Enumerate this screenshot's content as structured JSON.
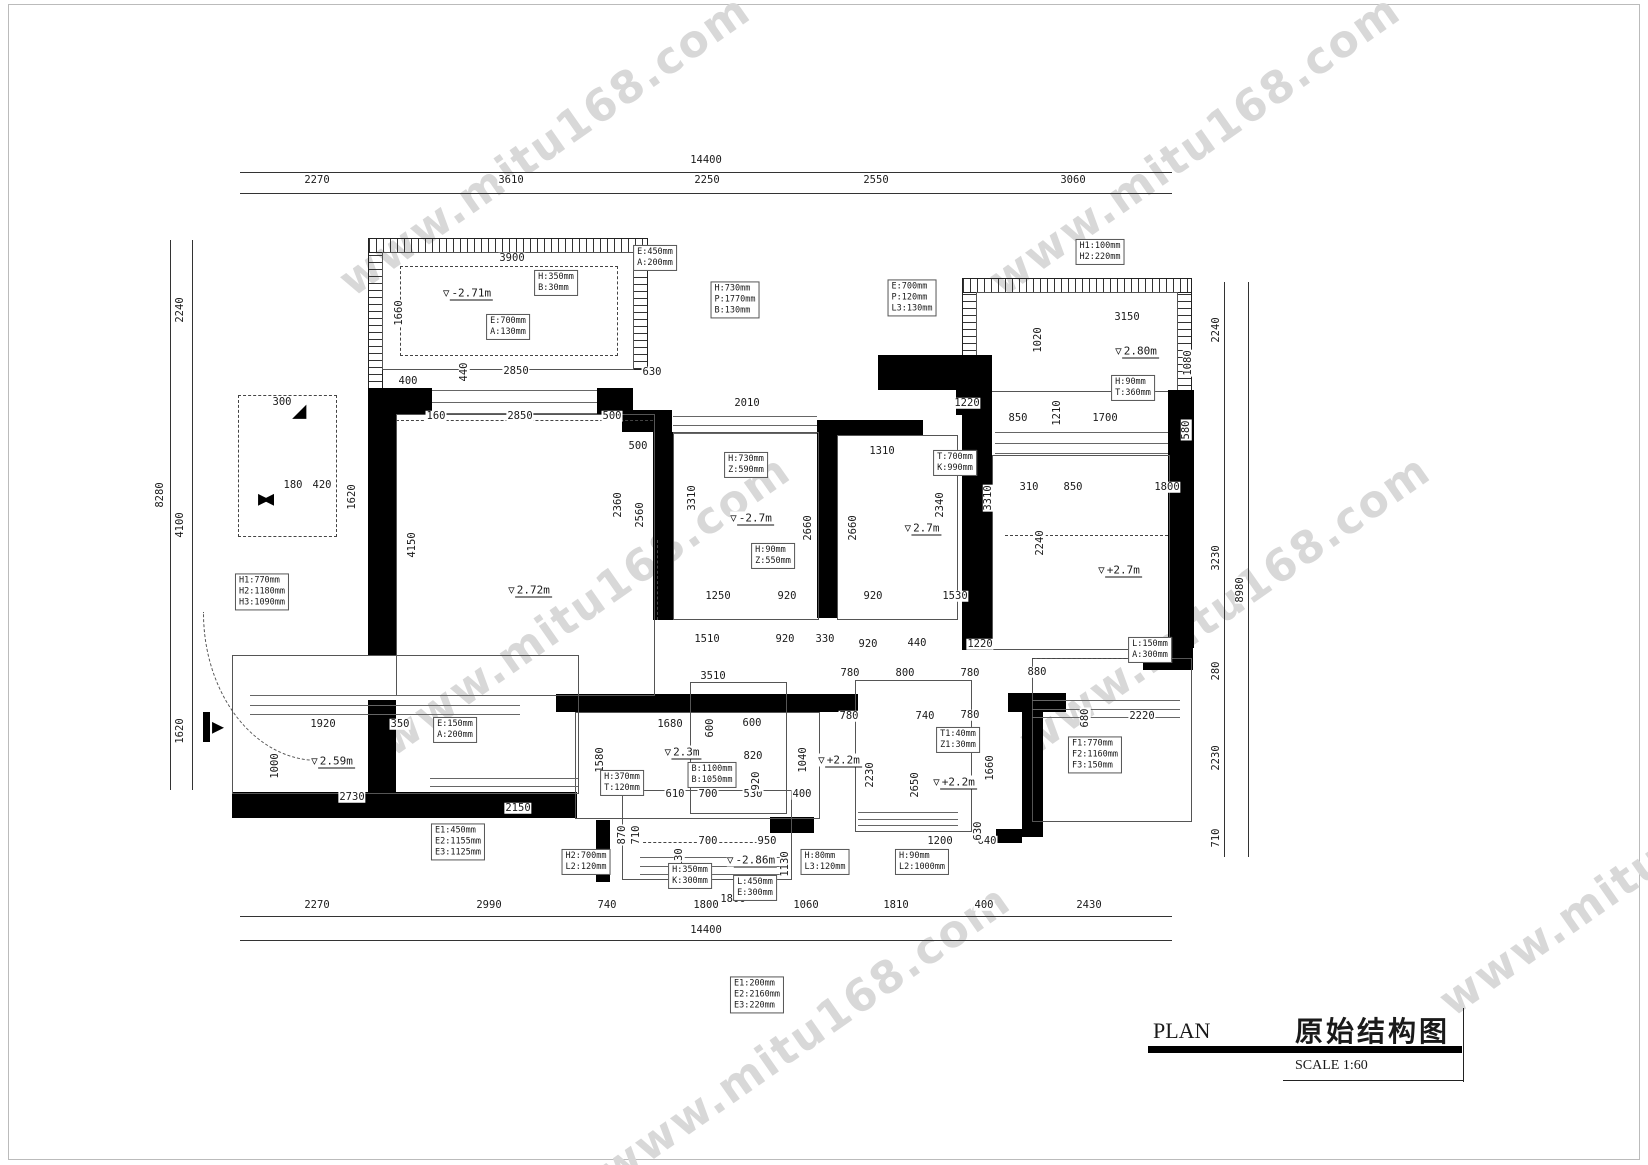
{
  "watermark": {
    "text": "www.mitu168.com",
    "color": "#d8d8d8"
  },
  "title_block": {
    "plan_label": "PLAN",
    "drawing_name": "原始结构图",
    "scale_label": "SCALE 1:60"
  },
  "icons": {
    "elevation_triangle": "▽",
    "corner_triangle": "◢",
    "bowtie": "▶◀",
    "entry_arrow": "▶"
  },
  "colors": {
    "line": "#1a1a1a",
    "wall": "#000000",
    "watermark": "#d8d8d8"
  },
  "dims_h": [
    {
      "t": "14400",
      "x": 706,
      "y": 160
    },
    {
      "t": "2270",
      "x": 317,
      "y": 180
    },
    {
      "t": "3610",
      "x": 511,
      "y": 180
    },
    {
      "t": "2250",
      "x": 707,
      "y": 180
    },
    {
      "t": "2550",
      "x": 876,
      "y": 180
    },
    {
      "t": "3060",
      "x": 1073,
      "y": 180
    },
    {
      "t": "2270",
      "x": 317,
      "y": 905
    },
    {
      "t": "2990",
      "x": 489,
      "y": 905
    },
    {
      "t": "740",
      "x": 607,
      "y": 905
    },
    {
      "t": "1800",
      "x": 706,
      "y": 905
    },
    {
      "t": "1060",
      "x": 806,
      "y": 905
    },
    {
      "t": "1810",
      "x": 896,
      "y": 905
    },
    {
      "t": "400",
      "x": 984,
      "y": 905
    },
    {
      "t": "2430",
      "x": 1089,
      "y": 905
    },
    {
      "t": "14400",
      "x": 706,
      "y": 930
    },
    {
      "t": "3900",
      "x": 512,
      "y": 258
    },
    {
      "t": "2850",
      "x": 516,
      "y": 371
    },
    {
      "t": "630",
      "x": 652,
      "y": 372
    },
    {
      "t": "400",
      "x": 408,
      "y": 381
    },
    {
      "t": "160",
      "x": 436,
      "y": 416
    },
    {
      "t": "2850",
      "x": 520,
      "y": 416
    },
    {
      "t": "500",
      "x": 612,
      "y": 416
    },
    {
      "t": "2010",
      "x": 747,
      "y": 403
    },
    {
      "t": "1220",
      "x": 967,
      "y": 403
    },
    {
      "t": "500",
      "x": 638,
      "y": 446
    },
    {
      "t": "1310",
      "x": 882,
      "y": 451
    },
    {
      "t": "3150",
      "x": 1127,
      "y": 317
    },
    {
      "t": "850",
      "x": 1018,
      "y": 418
    },
    {
      "t": "1700",
      "x": 1105,
      "y": 418
    },
    {
      "t": "310",
      "x": 1029,
      "y": 487
    },
    {
      "t": "850",
      "x": 1073,
      "y": 487
    },
    {
      "t": "1800",
      "x": 1167,
      "y": 487
    },
    {
      "t": "1250",
      "x": 718,
      "y": 596
    },
    {
      "t": "920",
      "x": 787,
      "y": 596
    },
    {
      "t": "920",
      "x": 873,
      "y": 596
    },
    {
      "t": "1530",
      "x": 955,
      "y": 596
    },
    {
      "t": "1510",
      "x": 707,
      "y": 639
    },
    {
      "t": "920",
      "x": 785,
      "y": 639
    },
    {
      "t": "330",
      "x": 825,
      "y": 639
    },
    {
      "t": "920",
      "x": 868,
      "y": 644
    },
    {
      "t": "440",
      "x": 917,
      "y": 643
    },
    {
      "t": "1220",
      "x": 980,
      "y": 644
    },
    {
      "t": "3510",
      "x": 713,
      "y": 676
    },
    {
      "t": "780",
      "x": 850,
      "y": 673
    },
    {
      "t": "800",
      "x": 905,
      "y": 673
    },
    {
      "t": "780",
      "x": 970,
      "y": 673
    },
    {
      "t": "880",
      "x": 1037,
      "y": 672
    },
    {
      "t": "780",
      "x": 849,
      "y": 716
    },
    {
      "t": "740",
      "x": 925,
      "y": 716
    },
    {
      "t": "780",
      "x": 970,
      "y": 715
    },
    {
      "t": "2220",
      "x": 1142,
      "y": 716
    },
    {
      "t": "1680",
      "x": 670,
      "y": 724
    },
    {
      "t": "600",
      "x": 752,
      "y": 723
    },
    {
      "t": "820",
      "x": 753,
      "y": 756
    },
    {
      "t": "610",
      "x": 675,
      "y": 794
    },
    {
      "t": "700",
      "x": 708,
      "y": 794
    },
    {
      "t": "530",
      "x": 753,
      "y": 794
    },
    {
      "t": "400",
      "x": 802,
      "y": 794
    },
    {
      "t": "700",
      "x": 708,
      "y": 841
    },
    {
      "t": "950",
      "x": 767,
      "y": 841
    },
    {
      "t": "1200",
      "x": 940,
      "y": 841
    },
    {
      "t": "640",
      "x": 987,
      "y": 841
    },
    {
      "t": "1800",
      "x": 733,
      "y": 899
    },
    {
      "t": "1920",
      "x": 323,
      "y": 724
    },
    {
      "t": "350",
      "x": 400,
      "y": 724
    },
    {
      "t": "2730",
      "x": 352,
      "y": 797
    },
    {
      "t": "2150",
      "x": 518,
      "y": 808
    },
    {
      "t": "300",
      "x": 282,
      "y": 402
    },
    {
      "t": "180",
      "x": 293,
      "y": 485
    },
    {
      "t": "420",
      "x": 322,
      "y": 485
    }
  ],
  "dims_v": [
    {
      "t": "2240",
      "x": 180,
      "y": 310
    },
    {
      "t": "8280",
      "x": 160,
      "y": 495
    },
    {
      "t": "4100",
      "x": 180,
      "y": 525
    },
    {
      "t": "1620",
      "x": 180,
      "y": 731
    },
    {
      "t": "2240",
      "x": 1216,
      "y": 330
    },
    {
      "t": "3230",
      "x": 1216,
      "y": 558
    },
    {
      "t": "8980",
      "x": 1240,
      "y": 590
    },
    {
      "t": "280",
      "x": 1216,
      "y": 671
    },
    {
      "t": "2230",
      "x": 1216,
      "y": 758
    },
    {
      "t": "710",
      "x": 1216,
      "y": 838
    },
    {
      "t": "1660",
      "x": 399,
      "y": 313
    },
    {
      "t": "440",
      "x": 464,
      "y": 372
    },
    {
      "t": "4150",
      "x": 412,
      "y": 545
    },
    {
      "t": "2560",
      "x": 640,
      "y": 515
    },
    {
      "t": "3310",
      "x": 692,
      "y": 498
    },
    {
      "t": "2660",
      "x": 808,
      "y": 528
    },
    {
      "t": "2660",
      "x": 853,
      "y": 528
    },
    {
      "t": "3310",
      "x": 988,
      "y": 498
    },
    {
      "t": "2340",
      "x": 940,
      "y": 505
    },
    {
      "t": "1020",
      "x": 1038,
      "y": 340
    },
    {
      "t": "1080",
      "x": 1188,
      "y": 363
    },
    {
      "t": "1210",
      "x": 1057,
      "y": 413
    },
    {
      "t": "580",
      "x": 1186,
      "y": 430
    },
    {
      "t": "2240",
      "x": 1040,
      "y": 543
    },
    {
      "t": "1620",
      "x": 352,
      "y": 497
    },
    {
      "t": "1580",
      "x": 600,
      "y": 760
    },
    {
      "t": "600",
      "x": 710,
      "y": 728
    },
    {
      "t": "1040",
      "x": 803,
      "y": 760
    },
    {
      "t": "920",
      "x": 756,
      "y": 781
    },
    {
      "t": "2650",
      "x": 915,
      "y": 785
    },
    {
      "t": "1660",
      "x": 990,
      "y": 768
    },
    {
      "t": "2230",
      "x": 870,
      "y": 775
    },
    {
      "t": "1130",
      "x": 679,
      "y": 861
    },
    {
      "t": "1130",
      "x": 785,
      "y": 864
    },
    {
      "t": "870",
      "x": 622,
      "y": 835
    },
    {
      "t": "710",
      "x": 636,
      "y": 835
    },
    {
      "t": "630",
      "x": 978,
      "y": 831
    },
    {
      "t": "1000",
      "x": 275,
      "y": 766
    },
    {
      "t": "680",
      "x": 1085,
      "y": 718
    },
    {
      "t": "2360",
      "x": 618,
      "y": 505
    }
  ],
  "elevations": [
    {
      "t": "-2.71m",
      "x": 468,
      "y": 293
    },
    {
      "t": "2.80m",
      "x": 1137,
      "y": 351
    },
    {
      "t": "-2.7m",
      "x": 752,
      "y": 518
    },
    {
      "t": "2.7m",
      "x": 923,
      "y": 528
    },
    {
      "t": "+2.7m",
      "x": 1120,
      "y": 570
    },
    {
      "t": "2.72m",
      "x": 530,
      "y": 590
    },
    {
      "t": "2.59m",
      "x": 333,
      "y": 761
    },
    {
      "t": "2.3m",
      "x": 683,
      "y": 752
    },
    {
      "t": "+2.2m",
      "x": 840,
      "y": 760
    },
    {
      "t": "+2.2m",
      "x": 955,
      "y": 782
    },
    {
      "t": "-2.86m",
      "x": 752,
      "y": 860
    }
  ],
  "notes": [
    {
      "x": 655,
      "y": 258,
      "lines": [
        "E:450mm",
        "A:200mm"
      ]
    },
    {
      "x": 735,
      "y": 300,
      "lines": [
        "H:730mm",
        "P:1770mm",
        "B:130mm"
      ]
    },
    {
      "x": 912,
      "y": 298,
      "lines": [
        "E:700mm",
        "P:120mm",
        "L3:130mm"
      ]
    },
    {
      "x": 1100,
      "y": 252,
      "lines": [
        "H1:100mm",
        "H2:220mm"
      ]
    },
    {
      "x": 556,
      "y": 283,
      "lines": [
        "H:350mm",
        "B:30mm"
      ]
    },
    {
      "x": 508,
      "y": 327,
      "lines": [
        "E:700mm",
        "A:130mm"
      ]
    },
    {
      "x": 746,
      "y": 465,
      "lines": [
        "H:730mm",
        "Z:590mm"
      ]
    },
    {
      "x": 955,
      "y": 463,
      "lines": [
        "T:700mm",
        "K:990mm"
      ]
    },
    {
      "x": 773,
      "y": 556,
      "lines": [
        "H:90mm",
        "Z:550mm"
      ]
    },
    {
      "x": 1133,
      "y": 388,
      "lines": [
        "H:90mm",
        "T:360mm"
      ]
    },
    {
      "x": 262,
      "y": 592,
      "lines": [
        "H1:770mm",
        "H2:1180mm",
        "H3:1090mm"
      ]
    },
    {
      "x": 455,
      "y": 730,
      "lines": [
        "E:150mm",
        "A:200mm"
      ]
    },
    {
      "x": 958,
      "y": 740,
      "lines": [
        "T1:40mm",
        "Z1:30mm"
      ]
    },
    {
      "x": 1150,
      "y": 650,
      "lines": [
        "L:150mm",
        "A:300mm"
      ]
    },
    {
      "x": 1095,
      "y": 755,
      "lines": [
        "F1:770mm",
        "F2:1160mm",
        "F3:150mm"
      ]
    },
    {
      "x": 622,
      "y": 783,
      "lines": [
        "H:370mm",
        "T:120mm"
      ]
    },
    {
      "x": 712,
      "y": 775,
      "lines": [
        "B:1100mm",
        "B:1050mm"
      ]
    },
    {
      "x": 690,
      "y": 876,
      "lines": [
        "H:350mm",
        "K:300mm"
      ]
    },
    {
      "x": 755,
      "y": 888,
      "lines": [
        "L:450mm",
        "E:300mm"
      ]
    },
    {
      "x": 458,
      "y": 842,
      "lines": [
        "E1:450mm",
        "E2:1155mm",
        "E3:1125mm"
      ]
    },
    {
      "x": 586,
      "y": 862,
      "lines": [
        "H2:700mm",
        "L2:120mm"
      ]
    },
    {
      "x": 825,
      "y": 862,
      "lines": [
        "H:80mm",
        "L3:120mm"
      ]
    },
    {
      "x": 922,
      "y": 862,
      "lines": [
        "H:90mm",
        "L2:1000mm"
      ]
    },
    {
      "x": 757,
      "y": 995,
      "lines": [
        "E1:200mm",
        "E2:2160mm",
        "E3:220mm"
      ]
    }
  ]
}
